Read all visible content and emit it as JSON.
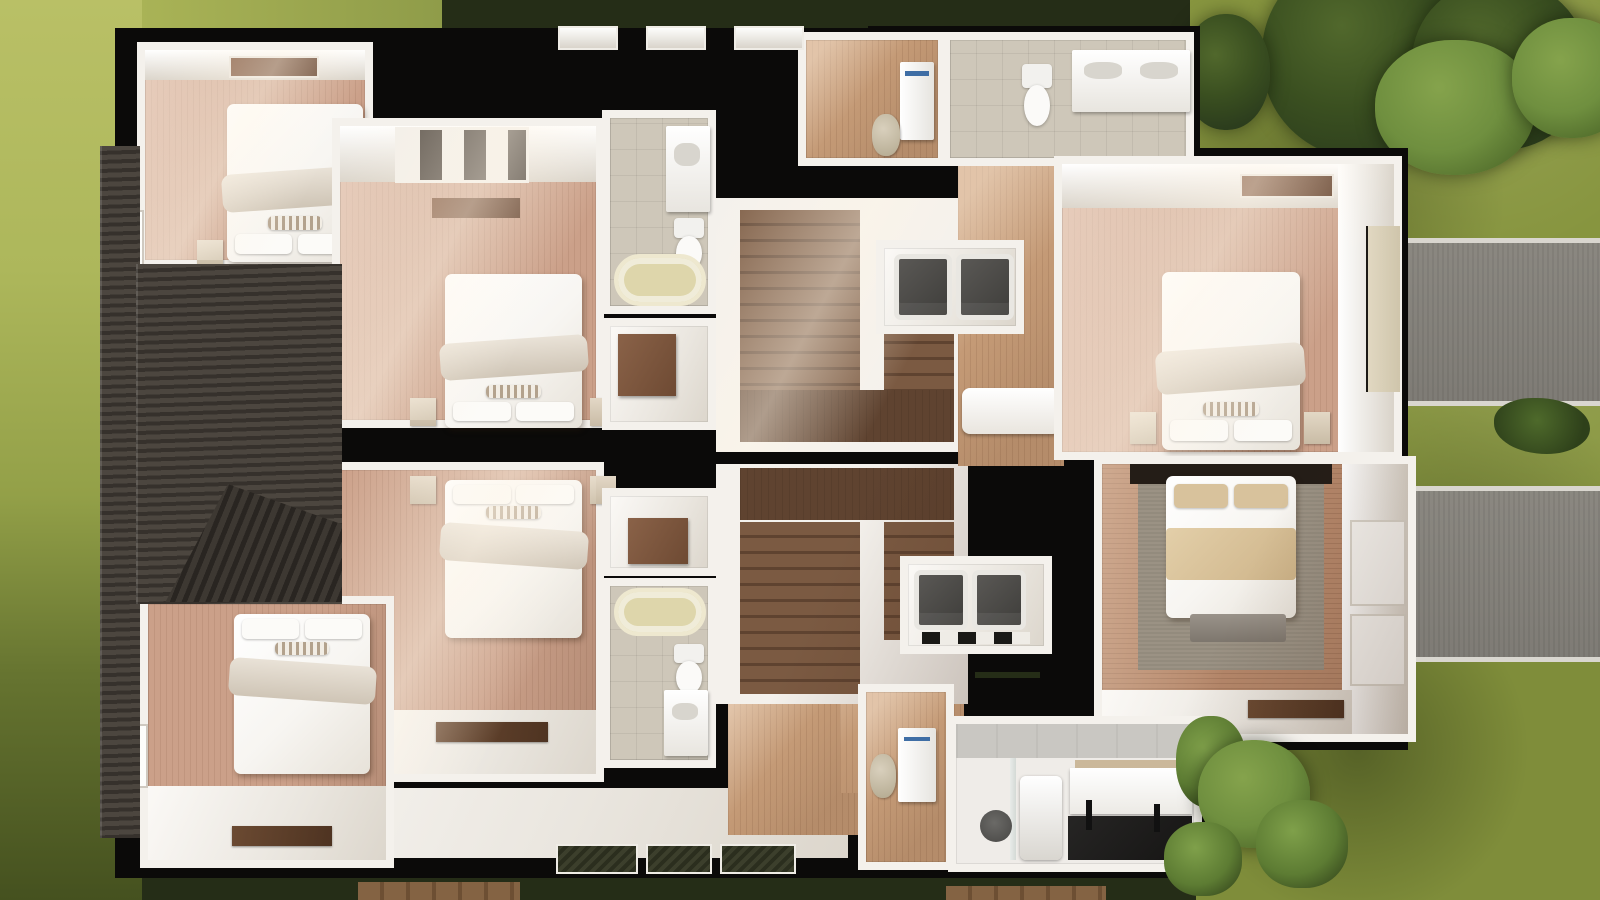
{
  "scene": {
    "kind": "3d-floor-plan-render",
    "view": "top-down cutaway of residential building with surrounding yard"
  },
  "palette": {
    "hedge": "#252d17",
    "lawn-right": "#87953f",
    "tree-dark": "#2c3d1d",
    "wall-black": "#0b0a09",
    "wall-white": "#f4f1ec",
    "wall-shade": "#d9d3c9",
    "floor-pink": "#cba089",
    "floor-tan": "#c49a76",
    "floor-brown": "#b5876a",
    "stair-wood": "#7b5a42",
    "stair-dark": "#5f4330",
    "tile": "#cec7b9",
    "tub": "#ded6ab",
    "appliance": "#4b4946",
    "bed-white": "#f7f5f1",
    "rug": "#9b9284",
    "roof": "#45403a",
    "concrete": "#c9c7c2",
    "driveway": "#83807a"
  },
  "exterior": [
    {
      "id": "lawn-left",
      "kind": "grass"
    },
    {
      "id": "lawn-right",
      "kind": "grass"
    },
    {
      "id": "hedge-top",
      "kind": "hedge"
    },
    {
      "id": "trees-top-right",
      "kind": "tree-cluster",
      "count": 5
    },
    {
      "id": "shrubs-bottom-right",
      "kind": "shrub-cluster",
      "count": 4
    },
    {
      "id": "driveway-upper",
      "kind": "driveway"
    },
    {
      "id": "driveway-lower",
      "kind": "driveway"
    },
    {
      "id": "planter-mid-right",
      "kind": "plant"
    },
    {
      "id": "boardwalk-bottom",
      "kind": "wood-planks"
    }
  ],
  "rooms": [
    {
      "id": "bedroom-top-left",
      "kind": "bedroom",
      "furniture": [
        "double-bed",
        "pillows",
        "nightstands",
        "dresser",
        "window"
      ]
    },
    {
      "id": "bedroom-mid-upper",
      "kind": "bedroom",
      "furniture": [
        "double-bed",
        "pillows",
        "nightstands",
        "wardrobe",
        "window"
      ]
    },
    {
      "id": "bedroom-mid-lower",
      "kind": "bedroom",
      "furniture": [
        "double-bed",
        "pillows",
        "nightstands",
        "desk",
        "window"
      ]
    },
    {
      "id": "bedroom-bottom-left",
      "kind": "bedroom",
      "furniture": [
        "double-bed",
        "pillows",
        "desk",
        "window"
      ]
    },
    {
      "id": "bathroom-center-upper",
      "kind": "bathroom",
      "furniture": [
        "bathtub",
        "toilet",
        "vanity"
      ]
    },
    {
      "id": "closet-center-upper",
      "kind": "closet",
      "furniture": [
        "wardrobe"
      ]
    },
    {
      "id": "closet-center-lower",
      "kind": "closet",
      "furniture": [
        "wardrobe"
      ]
    },
    {
      "id": "bathroom-center-lower",
      "kind": "bathroom",
      "furniture": [
        "bathtub",
        "toilet",
        "vanity"
      ]
    },
    {
      "id": "staircase-upper",
      "kind": "stairs",
      "furniture": [
        "stair-flight",
        "stair-landing"
      ]
    },
    {
      "id": "staircase-lower",
      "kind": "stairs",
      "furniture": [
        "stair-flight",
        "stair-landing"
      ]
    },
    {
      "id": "entry-hall-top",
      "kind": "hallway",
      "furniture": [
        "refrigerator",
        "armchair"
      ]
    },
    {
      "id": "bathroom-top-right",
      "kind": "bathroom",
      "furniture": [
        "toilet",
        "double-vanity"
      ]
    },
    {
      "id": "laundry-closet-upper",
      "kind": "laundry",
      "furniture": [
        "washer",
        "dryer"
      ]
    },
    {
      "id": "laundry-closet-lower",
      "kind": "laundry",
      "furniture": [
        "washer",
        "dryer"
      ]
    },
    {
      "id": "hallway-right",
      "kind": "hallway",
      "furniture": [
        "daybed"
      ]
    },
    {
      "id": "hallway-bottom",
      "kind": "hallway",
      "furniture": [
        "refrigerator",
        "armchair"
      ]
    },
    {
      "id": "bedroom-right-upper",
      "kind": "bedroom",
      "furniture": [
        "double-bed",
        "pillows",
        "nightstands",
        "entry-door"
      ]
    },
    {
      "id": "bedroom-right-lower",
      "kind": "bedroom",
      "furniture": [
        "double-bed",
        "tan-blanket",
        "rug",
        "bench",
        "desk",
        "doors"
      ]
    },
    {
      "id": "gym",
      "kind": "gym",
      "furniture": [
        "exercise-mat",
        "pilates-reformer",
        "weight-plate",
        "storage-cabinet",
        "glass-divider"
      ]
    }
  ],
  "roof": {
    "id": "roof-left",
    "kind": "shingle-roof",
    "features": [
      "gable-dormer"
    ]
  }
}
